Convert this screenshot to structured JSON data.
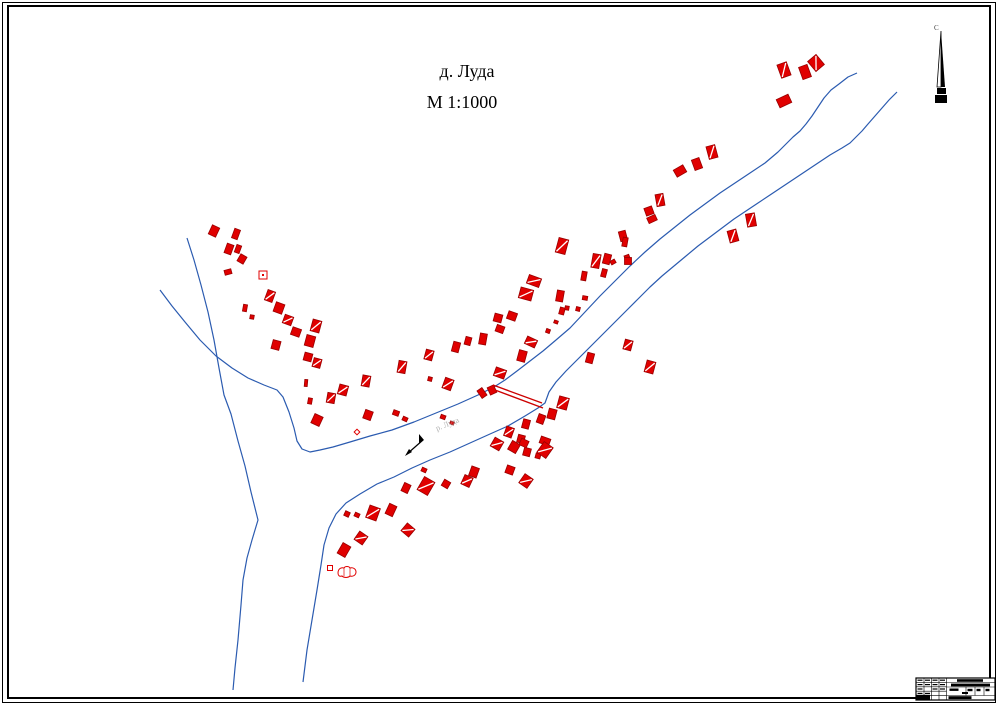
{
  "title": {
    "line1": "д. Луда",
    "line2": "М 1:1000"
  },
  "north_arrow": {
    "label": "С",
    "x": 941,
    "top": 31,
    "mid": 87,
    "bottom": 103
  },
  "river_label": {
    "text": "р. Луда",
    "x": 437,
    "y": 431,
    "rotation": -22,
    "color": "#b0b0b0"
  },
  "map": {
    "colors": {
      "river": "#2b5bb0",
      "building_fill": "#e00000",
      "building_stroke": "#990000",
      "bridge": "#cc0000",
      "ink": "#000000"
    },
    "rivers": [
      [
        [
          187,
          238
        ],
        [
          194,
          260
        ],
        [
          201,
          285
        ],
        [
          208,
          312
        ],
        [
          214,
          340
        ],
        [
          219,
          368
        ],
        [
          224,
          395
        ],
        [
          231,
          414
        ],
        [
          238,
          441
        ],
        [
          245,
          466
        ],
        [
          251,
          492
        ],
        [
          258,
          520
        ],
        [
          252,
          540
        ],
        [
          247,
          558
        ],
        [
          243,
          580
        ],
        [
          241,
          605
        ],
        [
          238,
          640
        ],
        [
          235,
          668
        ],
        [
          233,
          690
        ]
      ],
      [
        [
          160,
          290
        ],
        [
          172,
          306
        ],
        [
          185,
          322
        ],
        [
          200,
          340
        ],
        [
          216,
          356
        ],
        [
          232,
          368
        ],
        [
          248,
          378
        ],
        [
          264,
          385
        ],
        [
          277,
          390
        ],
        [
          283,
          397
        ],
        [
          289,
          412
        ],
        [
          294,
          428
        ],
        [
          297,
          441
        ],
        [
          302,
          449
        ],
        [
          310,
          452
        ],
        [
          320,
          450
        ],
        [
          333,
          447
        ],
        [
          350,
          442
        ],
        [
          370,
          436
        ],
        [
          392,
          430
        ],
        [
          414,
          422
        ],
        [
          436,
          413
        ],
        [
          458,
          404
        ],
        [
          478,
          395
        ],
        [
          494,
          387
        ],
        [
          505,
          380
        ],
        [
          517,
          371
        ],
        [
          530,
          361
        ],
        [
          543,
          351
        ],
        [
          556,
          340
        ],
        [
          570,
          328
        ],
        [
          585,
          312
        ],
        [
          600,
          296
        ],
        [
          615,
          281
        ],
        [
          630,
          266
        ],
        [
          645,
          252
        ],
        [
          660,
          239
        ],
        [
          675,
          227
        ],
        [
          690,
          215
        ],
        [
          705,
          204
        ],
        [
          720,
          193
        ],
        [
          735,
          183
        ],
        [
          750,
          173
        ],
        [
          765,
          163
        ],
        [
          778,
          152
        ],
        [
          786,
          144
        ],
        [
          793,
          137
        ],
        [
          800,
          131
        ],
        [
          806,
          124
        ],
        [
          812,
          116
        ],
        [
          818,
          107
        ],
        [
          824,
          98
        ],
        [
          831,
          90
        ],
        [
          839,
          84
        ],
        [
          848,
          77
        ],
        [
          857,
          73
        ]
      ],
      [
        [
          897,
          92
        ],
        [
          889,
          100
        ],
        [
          882,
          108
        ],
        [
          875,
          116
        ],
        [
          868,
          124
        ],
        [
          862,
          131
        ],
        [
          856,
          137
        ],
        [
          850,
          143
        ],
        [
          842,
          148
        ],
        [
          830,
          155
        ],
        [
          818,
          163
        ],
        [
          806,
          171
        ],
        [
          794,
          179
        ],
        [
          782,
          187
        ],
        [
          770,
          195
        ],
        [
          758,
          203
        ],
        [
          746,
          211
        ],
        [
          734,
          219
        ],
        [
          722,
          228
        ],
        [
          710,
          237
        ],
        [
          698,
          246
        ],
        [
          686,
          256
        ],
        [
          674,
          266
        ],
        [
          662,
          276
        ],
        [
          650,
          287
        ],
        [
          638,
          299
        ],
        [
          626,
          311
        ],
        [
          614,
          323
        ],
        [
          602,
          335
        ],
        [
          590,
          347
        ],
        [
          578,
          359
        ],
        [
          566,
          371
        ],
        [
          556,
          382
        ],
        [
          549,
          392
        ],
        [
          545,
          403
        ],
        [
          538,
          408
        ],
        [
          525,
          416
        ],
        [
          508,
          426
        ],
        [
          490,
          434
        ],
        [
          470,
          443
        ],
        [
          450,
          452
        ],
        [
          430,
          460
        ],
        [
          412,
          468
        ],
        [
          394,
          477
        ],
        [
          377,
          484
        ],
        [
          360,
          494
        ],
        [
          346,
          503
        ],
        [
          336,
          514
        ],
        [
          329,
          528
        ],
        [
          324,
          545
        ],
        [
          321,
          565
        ],
        [
          317,
          590
        ],
        [
          312,
          620
        ],
        [
          307,
          650
        ],
        [
          303,
          682
        ]
      ]
    ],
    "bridge": {
      "lines": [
        [
          493,
          385,
          542,
          403
        ],
        [
          495,
          390,
          543,
          408
        ]
      ]
    },
    "flow_arrow": {
      "x1": 423,
      "y1": 440,
      "x2": 407,
      "y2": 454
    },
    "building_styles": {
      "0": "solid",
      "1": "hatched",
      "2": "outline",
      "3": "outline-dot",
      "4": "blob"
    },
    "buildings": [
      [
        784,
        70,
        10,
        14,
        -20,
        1
      ],
      [
        805,
        72,
        9,
        13,
        -20,
        0
      ],
      [
        816,
        63,
        11,
        13,
        -40,
        1
      ],
      [
        784,
        101,
        13,
        9,
        -25,
        0
      ],
      [
        712,
        152,
        9,
        13,
        -15,
        1
      ],
      [
        697,
        164,
        8,
        11,
        -20,
        0
      ],
      [
        680,
        171,
        11,
        8,
        -30,
        0
      ],
      [
        660,
        200,
        8,
        12,
        -10,
        1
      ],
      [
        649,
        211,
        8,
        8,
        -20,
        0
      ],
      [
        652,
        219,
        9,
        6,
        -25,
        0
      ],
      [
        623,
        236,
        7,
        10,
        -15,
        0
      ],
      [
        627,
        257,
        5,
        4,
        -20,
        0
      ],
      [
        613,
        262,
        5,
        4,
        -30,
        0
      ],
      [
        751,
        220,
        9,
        13,
        -10,
        1
      ],
      [
        733,
        236,
        9,
        12,
        -15,
        1
      ],
      [
        562,
        246,
        10,
        15,
        15,
        1
      ],
      [
        596,
        261,
        8,
        14,
        10,
        1
      ],
      [
        607,
        259,
        7,
        10,
        15,
        0
      ],
      [
        625,
        242,
        5,
        9,
        10,
        0
      ],
      [
        628,
        261,
        7,
        7,
        0,
        0
      ],
      [
        584,
        276,
        5,
        9,
        10,
        0
      ],
      [
        604,
        273,
        5,
        8,
        15,
        0
      ],
      [
        534,
        281,
        13,
        9,
        20,
        1
      ],
      [
        526,
        294,
        13,
        11,
        15,
        1
      ],
      [
        560,
        296,
        7,
        11,
        10,
        0
      ],
      [
        562,
        311,
        5,
        7,
        15,
        0
      ],
      [
        512,
        316,
        9,
        8,
        20,
        0
      ],
      [
        498,
        318,
        8,
        8,
        15,
        0
      ],
      [
        500,
        329,
        8,
        7,
        20,
        0
      ],
      [
        483,
        339,
        7,
        11,
        10,
        0
      ],
      [
        531,
        342,
        11,
        8,
        25,
        1
      ],
      [
        522,
        356,
        8,
        11,
        15,
        0
      ],
      [
        500,
        373,
        11,
        9,
        20,
        1
      ],
      [
        548,
        331,
        4,
        4,
        20,
        0
      ],
      [
        567,
        308,
        4,
        4,
        10,
        0
      ],
      [
        578,
        309,
        4,
        4,
        15,
        0
      ],
      [
        585,
        298,
        5,
        4,
        10,
        0
      ],
      [
        556,
        322,
        4,
        3,
        20,
        0
      ],
      [
        482,
        393,
        6,
        9,
        -35,
        0
      ],
      [
        492,
        390,
        7,
        8,
        -25,
        0
      ],
      [
        396,
        413,
        6,
        5,
        20,
        0
      ],
      [
        405,
        419,
        5,
        4,
        25,
        0
      ],
      [
        317,
        420,
        9,
        10,
        25,
        0
      ],
      [
        357,
        432,
        4,
        4,
        45,
        2
      ],
      [
        214,
        231,
        8,
        10,
        25,
        0
      ],
      [
        236,
        234,
        6,
        10,
        20,
        0
      ],
      [
        229,
        249,
        7,
        10,
        20,
        0
      ],
      [
        238,
        249,
        5,
        8,
        20,
        0
      ],
      [
        242,
        259,
        7,
        8,
        30,
        0
      ],
      [
        228,
        272,
        7,
        5,
        -15,
        0
      ],
      [
        263,
        275,
        8,
        8,
        0,
        3
      ],
      [
        270,
        296,
        8,
        11,
        20,
        1
      ],
      [
        279,
        308,
        9,
        10,
        20,
        0
      ],
      [
        288,
        320,
        9,
        9,
        20,
        1
      ],
      [
        296,
        332,
        9,
        8,
        20,
        0
      ],
      [
        245,
        308,
        4,
        7,
        10,
        0
      ],
      [
        252,
        317,
        4,
        4,
        10,
        0
      ],
      [
        276,
        345,
        8,
        9,
        15,
        0
      ],
      [
        316,
        326,
        9,
        12,
        15,
        1
      ],
      [
        310,
        341,
        9,
        11,
        15,
        0
      ],
      [
        308,
        357,
        8,
        8,
        15,
        0
      ],
      [
        317,
        363,
        8,
        9,
        15,
        1
      ],
      [
        306,
        383,
        3,
        7,
        5,
        0
      ],
      [
        310,
        401,
        4,
        6,
        10,
        0
      ],
      [
        331,
        398,
        8,
        10,
        10,
        1
      ],
      [
        343,
        390,
        9,
        10,
        15,
        1
      ],
      [
        366,
        381,
        8,
        11,
        10,
        1
      ],
      [
        368,
        415,
        8,
        9,
        20,
        0
      ],
      [
        402,
        367,
        8,
        12,
        10,
        1
      ],
      [
        429,
        355,
        8,
        10,
        15,
        1
      ],
      [
        448,
        384,
        9,
        11,
        20,
        1
      ],
      [
        456,
        347,
        7,
        10,
        15,
        0
      ],
      [
        468,
        341,
        6,
        8,
        15,
        0
      ],
      [
        430,
        379,
        4,
        4,
        15,
        0
      ],
      [
        443,
        417,
        5,
        4,
        20,
        0
      ],
      [
        452,
        423,
        4,
        3,
        20,
        0
      ],
      [
        563,
        403,
        10,
        12,
        15,
        1
      ],
      [
        552,
        414,
        8,
        10,
        15,
        0
      ],
      [
        541,
        419,
        7,
        9,
        20,
        0
      ],
      [
        526,
        424,
        7,
        9,
        15,
        0
      ],
      [
        509,
        432,
        8,
        10,
        20,
        1
      ],
      [
        521,
        439,
        7,
        8,
        15,
        0
      ],
      [
        545,
        441,
        10,
        7,
        20,
        0
      ],
      [
        527,
        452,
        7,
        8,
        15,
        0
      ],
      [
        538,
        456,
        5,
        5,
        15,
        0
      ],
      [
        510,
        470,
        8,
        8,
        20,
        0
      ],
      [
        590,
        358,
        7,
        10,
        15,
        0
      ],
      [
        628,
        345,
        8,
        10,
        15,
        1
      ],
      [
        650,
        367,
        9,
        12,
        15,
        1
      ],
      [
        497,
        444,
        10,
        10,
        30,
        1
      ],
      [
        514,
        447,
        9,
        10,
        30,
        0
      ],
      [
        524,
        443,
        8,
        7,
        25,
        0
      ],
      [
        545,
        450,
        11,
        13,
        35,
        1
      ],
      [
        526,
        481,
        10,
        11,
        35,
        1
      ],
      [
        474,
        472,
        8,
        10,
        20,
        0
      ],
      [
        467,
        481,
        9,
        10,
        25,
        1
      ],
      [
        446,
        484,
        7,
        7,
        30,
        0
      ],
      [
        426,
        486,
        12,
        15,
        30,
        1
      ],
      [
        406,
        488,
        7,
        9,
        25,
        0
      ],
      [
        424,
        470,
        5,
        4,
        25,
        0
      ],
      [
        408,
        530,
        10,
        10,
        40,
        1
      ],
      [
        391,
        510,
        8,
        11,
        25,
        0
      ],
      [
        373,
        513,
        11,
        13,
        20,
        1
      ],
      [
        361,
        538,
        10,
        10,
        35,
        1
      ],
      [
        344,
        550,
        9,
        12,
        30,
        0
      ],
      [
        347,
        514,
        5,
        5,
        25,
        0
      ],
      [
        357,
        515,
        5,
        4,
        25,
        0
      ],
      [
        330,
        568,
        5,
        5,
        0,
        2
      ],
      [
        347,
        572,
        16,
        11,
        0,
        4
      ]
    ]
  },
  "stamp": {
    "x": 916,
    "y": 678,
    "w": 79,
    "h": 22,
    "grid_cols": [
      8,
      15.5,
      23,
      30.5
    ],
    "grid_rows": [
      4.4,
      8.8,
      13.2,
      17.6
    ],
    "right_rows": [
      4.5,
      9,
      17.5
    ],
    "cell_cols": [
      50,
      59,
      68
    ],
    "bars": [
      [
        41,
        1.2,
        26,
        2.6
      ],
      [
        35,
        5.6,
        39,
        2.8
      ],
      [
        33.5,
        10.5,
        9,
        2.4
      ],
      [
        51.5,
        10.8,
        5,
        2.4
      ],
      [
        60.5,
        10.8,
        4,
        2.4
      ],
      [
        69.5,
        10.8,
        4,
        2.4
      ],
      [
        46,
        14,
        6,
        2
      ],
      [
        32.5,
        18.2,
        23,
        2.9
      ],
      [
        0.5,
        16.8,
        13.5,
        4.7
      ],
      [
        1.5,
        1.6,
        5,
        1.2
      ],
      [
        9,
        1.6,
        5,
        1.2
      ],
      [
        16.5,
        1.6,
        5,
        1.2
      ],
      [
        24,
        1.6,
        5,
        1.2
      ],
      [
        1.5,
        6,
        5,
        1.2
      ],
      [
        9,
        6,
        5,
        1.2
      ],
      [
        16.5,
        6,
        5,
        1.2
      ],
      [
        24,
        6,
        5,
        1.2
      ],
      [
        1.5,
        10.4,
        5,
        1.2
      ],
      [
        16.5,
        10.4,
        5,
        1.2
      ],
      [
        24,
        10.4,
        5,
        1.2
      ],
      [
        1.5,
        14.8,
        5,
        1.2
      ],
      [
        9,
        14.8,
        5,
        1.2
      ]
    ]
  }
}
